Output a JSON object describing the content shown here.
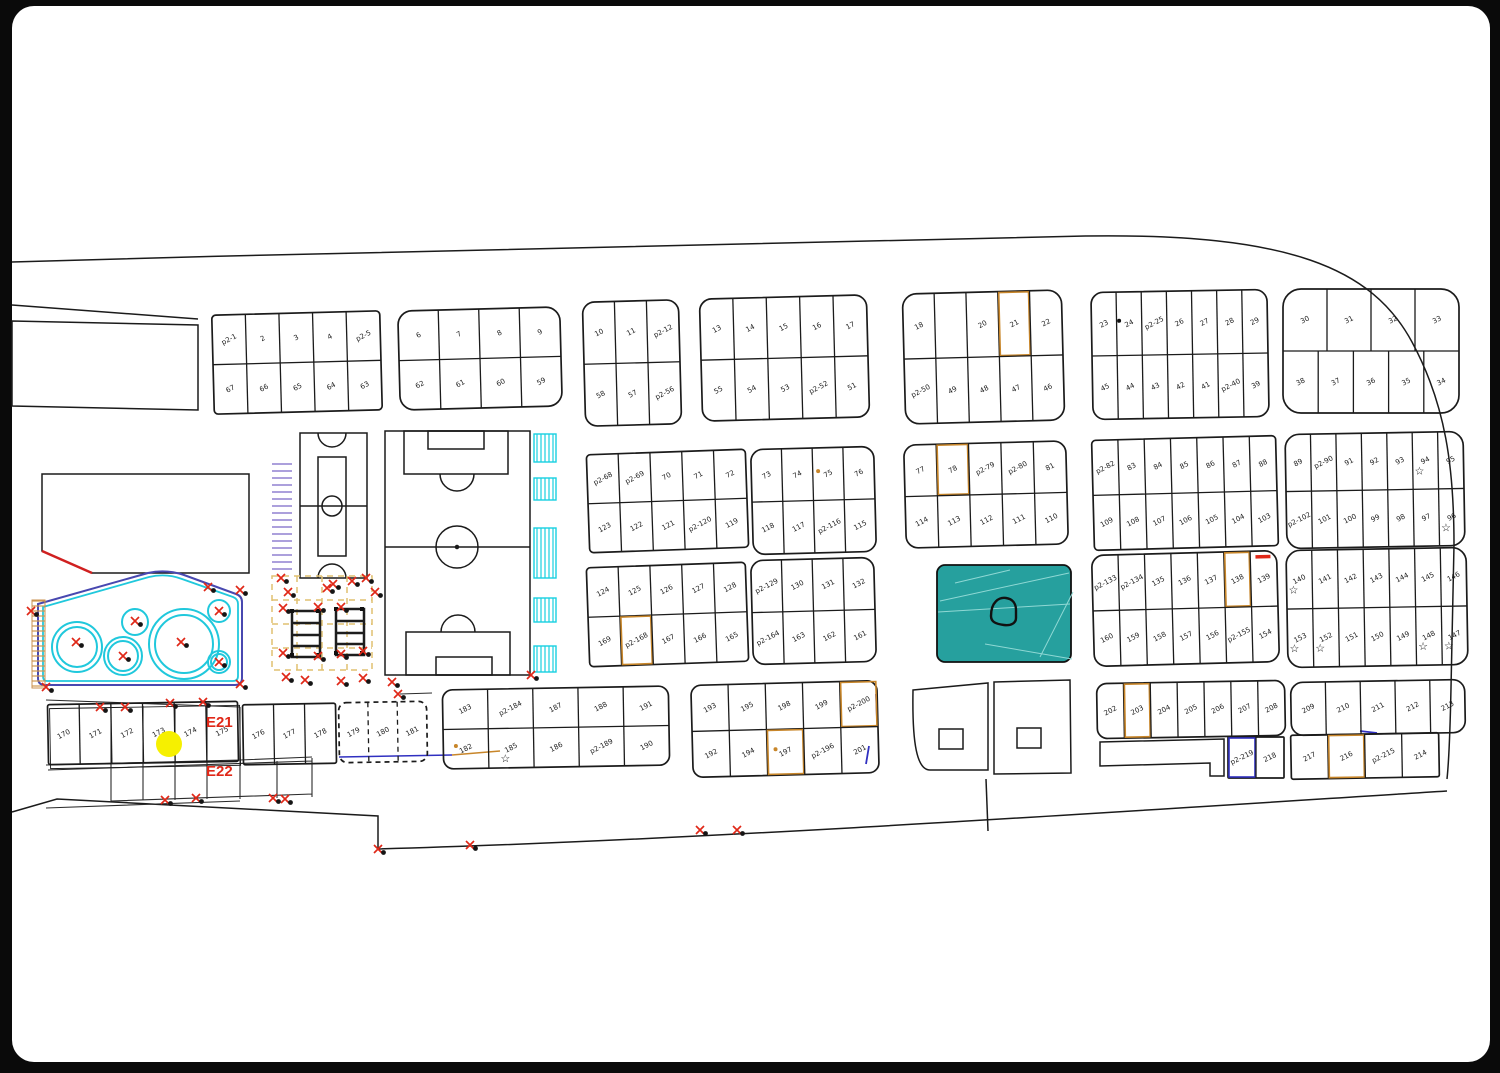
{
  "plan": {
    "labels": {
      "e21": "E21",
      "e22": "E22"
    },
    "colors": {
      "line": "#1b1b1b",
      "orange": "#c8862a",
      "blue": "#3030c0",
      "red": "#e02818",
      "cyan": "#20c8dc",
      "navy": "#4848b0",
      "teal": "#26a09e",
      "tan": "#e0c070",
      "purple": "#9080d0",
      "yellow": "#f6f000"
    },
    "park": {
      "x": 937,
      "y": 565,
      "w": 134,
      "h": 97
    },
    "blocks": [
      {
        "x": 213,
        "y": 313,
        "w": 168,
        "h": 99,
        "rot": -1.5,
        "rx": 4,
        "rows": [
          [
            "p2-1",
            "2",
            "3",
            "4",
            "p2-5"
          ],
          [
            "67",
            "66",
            "65",
            "64",
            "63"
          ]
        ]
      },
      {
        "x": 399,
        "y": 309,
        "w": 162,
        "h": 99,
        "rot": -1.5,
        "rx": 14,
        "rows": [
          [
            "6",
            "7",
            "8",
            "9"
          ],
          [
            "62",
            "61",
            "60",
            "59"
          ]
        ]
      },
      {
        "x": 584,
        "y": 301,
        "w": 96,
        "h": 124,
        "rot": -1.5,
        "rx": 12,
        "rows": [
          [
            "10",
            "11",
            "p2-12"
          ],
          [
            "58",
            "57",
            "p2-56"
          ]
        ]
      },
      {
        "x": 701,
        "y": 297,
        "w": 167,
        "h": 122,
        "rot": -1.5,
        "rx": 12,
        "rows": [
          [
            "13",
            "14",
            "15",
            "16",
            "17"
          ],
          [
            "55",
            "54",
            "53",
            "p2-52",
            "51"
          ]
        ]
      },
      {
        "x": 904,
        "y": 292,
        "w": 159,
        "h": 130,
        "rot": -1.5,
        "rx": 14,
        "rows": [
          [
            "18",
            "",
            "20",
            {
              "t": "21",
              "hl": "orange"
            },
            "22"
          ],
          [
            "p2-50",
            "49",
            "48",
            "47",
            "46"
          ]
        ]
      },
      {
        "x": 1092,
        "y": 291,
        "w": 176,
        "h": 127,
        "rot": -1,
        "rx": 12,
        "rows": [
          [
            "23",
            {
              "t": "24",
              "dot": "black"
            },
            "p2-25",
            "26",
            "27",
            "28",
            "29"
          ],
          [
            "45",
            "44",
            "43",
            "42",
            "41",
            "p2-40",
            "39"
          ]
        ]
      },
      {
        "x": 1283,
        "y": 289,
        "w": 176,
        "h": 124,
        "rot": 0,
        "rx": 18,
        "rows": [
          [
            "30",
            "31",
            "32",
            "33"
          ],
          [
            "38",
            "37",
            "36",
            "35",
            "34"
          ]
        ]
      },
      {
        "x": 588,
        "y": 452,
        "w": 159,
        "h": 98,
        "rot": -2,
        "rx": 4,
        "rows": [
          [
            "p2-68",
            "p2-69",
            "70",
            "71",
            "72"
          ],
          [
            "123",
            "122",
            "121",
            "p2-120",
            "119"
          ]
        ]
      },
      {
        "x": 752,
        "y": 448,
        "w": 123,
        "h": 105,
        "rot": -1.5,
        "rx": 12,
        "rows": [
          [
            "73",
            "74",
            {
              "t": "75",
              "dot": "orange"
            },
            "76"
          ],
          [
            "118",
            "117",
            "p2-116",
            "115"
          ]
        ]
      },
      {
        "x": 905,
        "y": 443,
        "w": 162,
        "h": 103,
        "rot": -1.5,
        "rx": 12,
        "rows": [
          [
            "77",
            {
              "t": "78",
              "hl": "orange"
            },
            "p2-79",
            "p2-80",
            "81"
          ],
          [
            "114",
            "113",
            "112",
            "111",
            "110"
          ]
        ]
      },
      {
        "x": 1093,
        "y": 438,
        "w": 184,
        "h": 110,
        "rot": -1.5,
        "rx": 4,
        "rows": [
          [
            "p2-82",
            "83",
            "84",
            "85",
            "86",
            "87",
            "88"
          ],
          [
            "109",
            "108",
            "107",
            "106",
            "105",
            "104",
            "103"
          ]
        ]
      },
      {
        "x": 1286,
        "y": 433,
        "w": 178,
        "h": 114,
        "rot": -1,
        "rx": 14,
        "rows": [
          [
            "89",
            "p2-90",
            "91",
            "92",
            "93",
            {
              "t": "94",
              "star": true
            },
            "95"
          ],
          [
            "p2-102",
            "101",
            "100",
            "99",
            "98",
            "97",
            {
              "t": "96",
              "star": true
            }
          ]
        ]
      },
      {
        "x": 588,
        "y": 565,
        "w": 159,
        "h": 99,
        "rot": -2,
        "rx": 4,
        "rows": [
          [
            "124",
            "125",
            "126",
            "127",
            "128"
          ],
          [
            "169",
            {
              "t": "p2-168",
              "hl": "orange"
            },
            "167",
            "166",
            "165"
          ]
        ]
      },
      {
        "x": 752,
        "y": 559,
        "w": 123,
        "h": 104,
        "rot": -1.5,
        "rx": 12,
        "rows": [
          [
            "p2-129",
            "130",
            "131",
            "132"
          ],
          [
            "p2-164",
            "163",
            "162",
            "161"
          ]
        ]
      },
      {
        "x": 1093,
        "y": 553,
        "w": 185,
        "h": 111,
        "rot": -1.5,
        "rx": 12,
        "rows": [
          [
            "p2-133",
            "p2-134",
            "135",
            "136",
            "137",
            {
              "t": "138",
              "hl": "orange"
            },
            {
              "t": "139",
              "bar": "red"
            }
          ],
          [
            "160",
            "159",
            "158",
            "157",
            "156",
            "p2-155",
            "154"
          ]
        ]
      },
      {
        "x": 1287,
        "y": 549,
        "w": 180,
        "h": 117,
        "rot": -1,
        "rx": 14,
        "rows": [
          [
            {
              "t": "140",
              "star": true
            },
            "141",
            "142",
            "143",
            "144",
            "145",
            "146"
          ],
          [
            {
              "t": "153",
              "star": true
            },
            {
              "t": "152",
              "star": true
            },
            "151",
            "150",
            "149",
            {
              "t": "148",
              "star": true
            },
            {
              "t": "147",
              "star": true
            }
          ]
        ]
      },
      {
        "x": 48,
        "y": 703,
        "w": 190,
        "h": 60,
        "rot": -1,
        "rx": 2,
        "double": true,
        "rows": [
          [
            "170",
            "171",
            "172",
            "173",
            "174",
            "175"
          ]
        ]
      },
      {
        "x": 243,
        "y": 704,
        "w": 93,
        "h": 60,
        "rot": -1,
        "rx": 2,
        "rows": [
          [
            "176",
            "177",
            "178"
          ]
        ]
      },
      {
        "x": 339,
        "y": 702,
        "w": 88,
        "h": 60,
        "rot": -1,
        "rx": 8,
        "dash": true,
        "rows": [
          [
            "179",
            "180",
            "181"
          ]
        ]
      },
      {
        "x": 443,
        "y": 688,
        "w": 226,
        "h": 79,
        "rot": -1,
        "rx": 10,
        "rows": [
          [
            "183",
            "p2-184",
            "187",
            "188",
            "191"
          ],
          [
            {
              "t": "182",
              "dot": "orange"
            },
            {
              "t": "185",
              "star": true
            },
            "186",
            "p2-189",
            "190"
          ]
        ]
      },
      {
        "x": 692,
        "y": 683,
        "w": 186,
        "h": 92,
        "rot": -1.5,
        "rx": 10,
        "rows": [
          [
            "193",
            "195",
            "198",
            "199",
            {
              "t": "p2-200",
              "hl": "orange"
            }
          ],
          [
            "192",
            "194",
            {
              "t": "197",
              "hl": "orange",
              "dot": "orange"
            },
            "p2-196",
            "201"
          ]
        ]
      },
      {
        "x": 1097,
        "y": 682,
        "w": 188,
        "h": 55,
        "rot": -1,
        "rx": 10,
        "rows": [
          [
            "202",
            {
              "t": "203",
              "hl": "orange"
            },
            "204",
            "205",
            "206",
            "207",
            "208"
          ]
        ]
      },
      {
        "x": 1228,
        "y": 737,
        "w": 56,
        "h": 41,
        "rot": 0,
        "rx": 1,
        "rows": [
          [
            {
              "t": "p2-219",
              "hl": "blue"
            },
            "218"
          ]
        ]
      },
      {
        "x": 1291,
        "y": 681,
        "w": 174,
        "h": 53,
        "rot": -1,
        "rx": 12,
        "rows": [
          [
            "209",
            "210",
            "211",
            "212",
            "213"
          ]
        ]
      },
      {
        "x": 1291,
        "y": 734,
        "w": 148,
        "h": 44,
        "rot": -1,
        "rx": 2,
        "rows": [
          [
            "217",
            {
              "t": "216",
              "hl": "orange"
            },
            "p2-215",
            "214"
          ]
        ]
      }
    ]
  }
}
